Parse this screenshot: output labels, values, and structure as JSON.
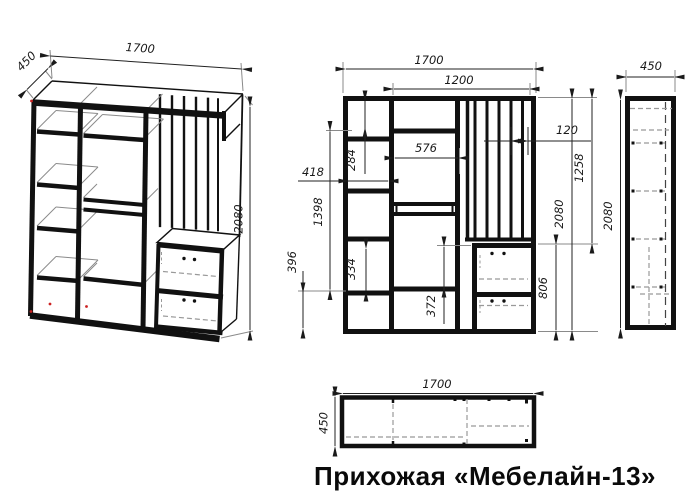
{
  "title": "Прихожая «Мебелайн-13»",
  "drawing": {
    "product": "Прихожая «Мебелайн-13»",
    "views": [
      "isometric",
      "front",
      "side",
      "plan"
    ]
  },
  "dimensions": {
    "width": "1700",
    "depth": "450",
    "height": "2080",
    "inner_width": "1200",
    "shelf_span": "576",
    "slat_spacing": "120",
    "left_top_section": "284",
    "left_column_width": "418",
    "left_middle_span": "1398",
    "left_bottom_section": "396",
    "left_shelf_section": "334",
    "middle_bottom_section": "372",
    "upper_right_span": "1258",
    "drawer_unit_height": "806"
  }
}
